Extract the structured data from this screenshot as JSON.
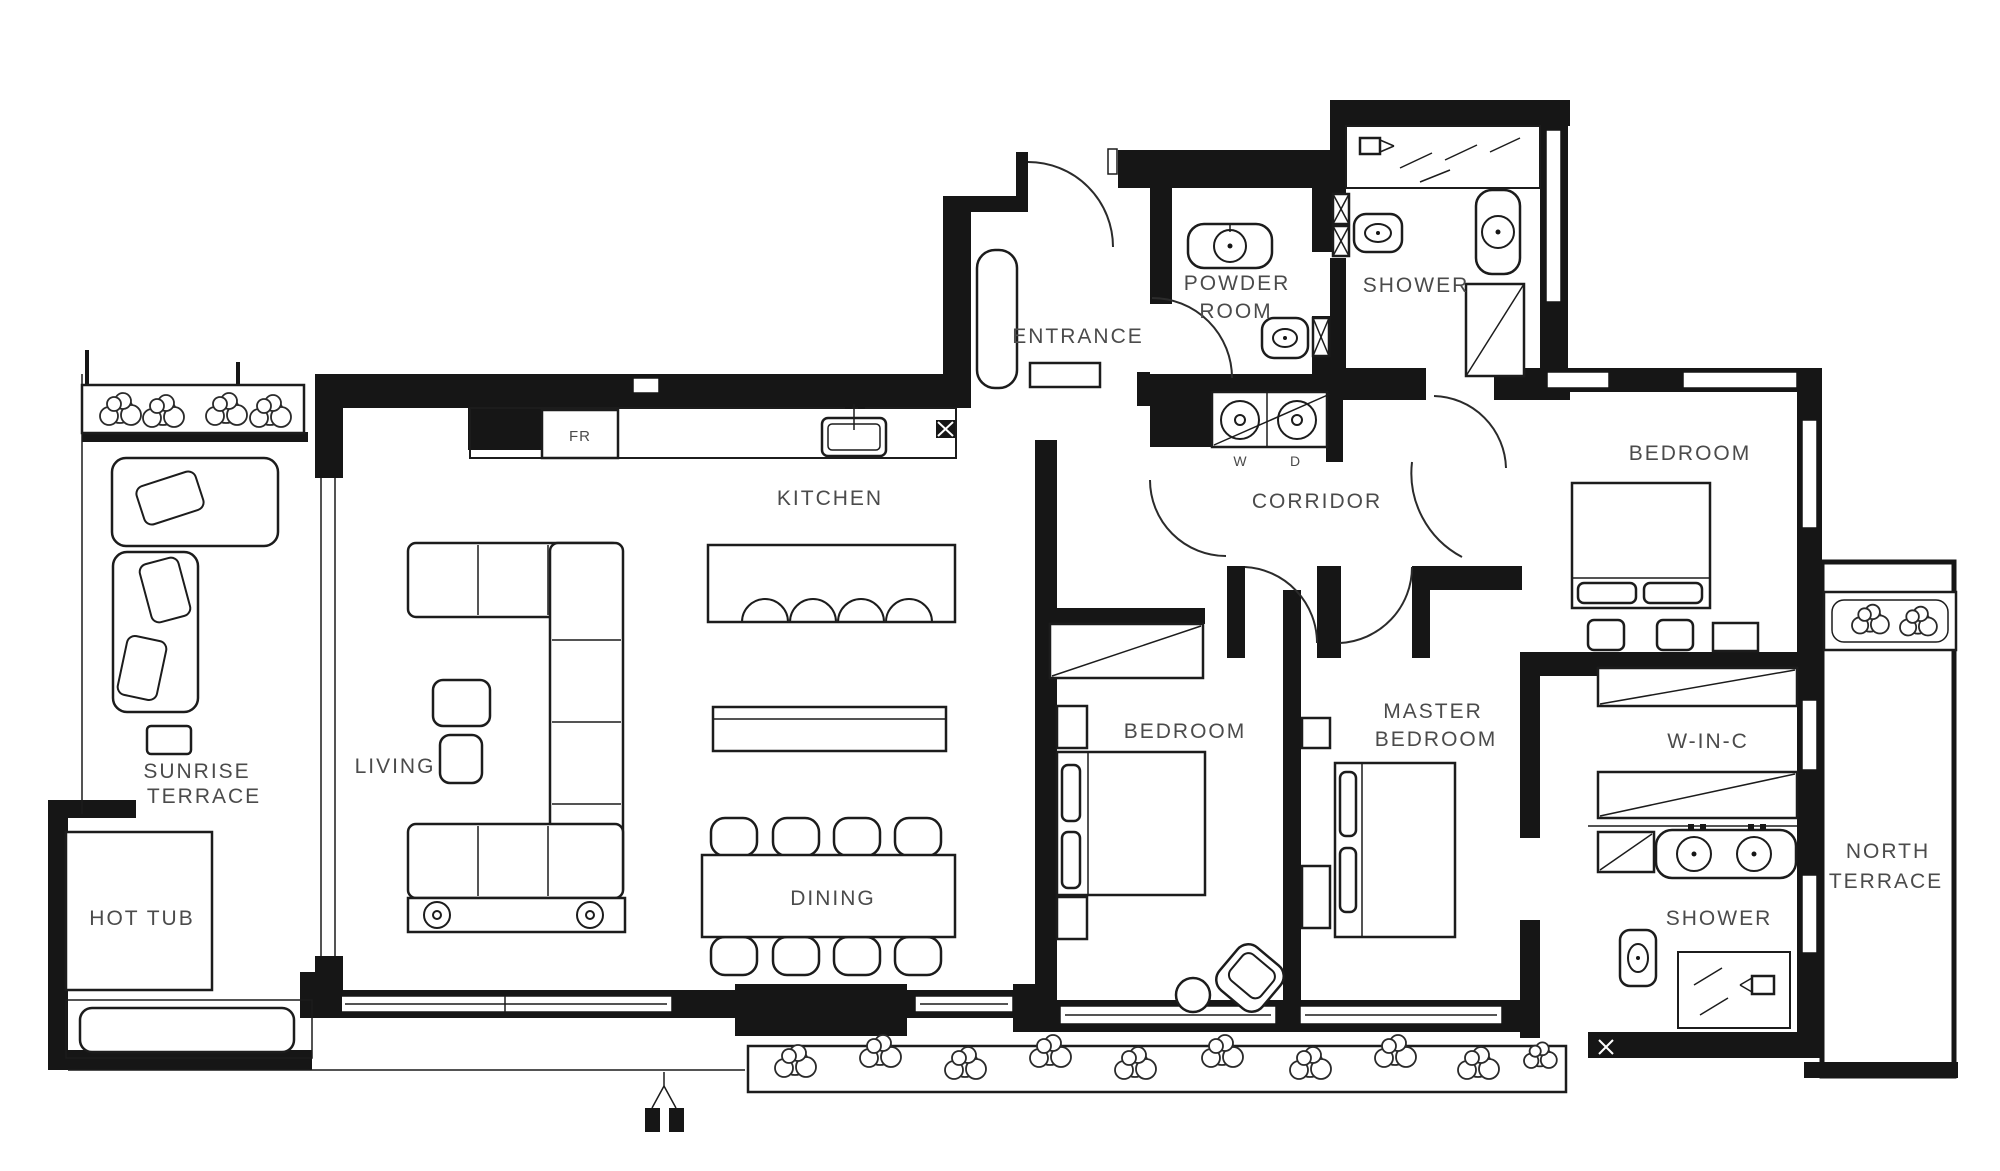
{
  "labels": {
    "sunrise1": "SUNRISE",
    "sunrise2": "TERRACE",
    "hot_tub": "HOT TUB",
    "living": "LIVING",
    "kitchen": "KITCHEN",
    "dining": "DINING",
    "entrance": "ENTRANCE",
    "fr": "FR",
    "powder1": "POWDER",
    "powder2": "ROOM",
    "shower_top": "SHOWER",
    "corridor": "CORRIDOR",
    "washer": "W",
    "dryer": "D",
    "bedroom_top": "BEDROOM",
    "bedroom_mid": "BEDROOM",
    "master1": "MASTER",
    "master2": "BEDROOM",
    "winc": "W-IN-C",
    "shower_bottom": "SHOWER",
    "north1": "NORTH",
    "north2": "TERRACE"
  },
  "colors": {
    "wall": "#161616",
    "furniture_line": "#1c1c1c",
    "label_text": "#4b4b4b",
    "background": "#ffffff"
  }
}
